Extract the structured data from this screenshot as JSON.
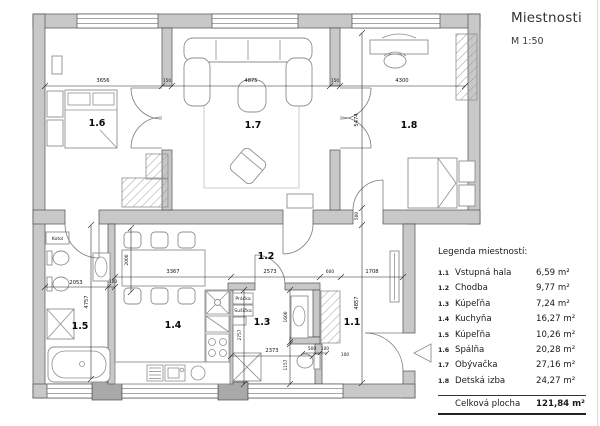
{
  "header": {
    "title": "Miestnosti",
    "scale": "M 1:50"
  },
  "legend": {
    "heading": "Legenda miestností:",
    "rows": [
      {
        "num": "1.1",
        "name": "Vstupná hala",
        "area": "6,59 m²"
      },
      {
        "num": "1.2",
        "name": "Chodba",
        "area": "9,77 m²"
      },
      {
        "num": "1.3",
        "name": "Kúpeľňa",
        "area": "7,24 m²"
      },
      {
        "num": "1.4",
        "name": "Kuchyňa",
        "area": "16,27 m²"
      },
      {
        "num": "1.5",
        "name": "Kúpeľňa",
        "area": "10,26 m²"
      },
      {
        "num": "1.6",
        "name": "Spálňa",
        "area": "20,28 m²"
      },
      {
        "num": "1.7",
        "name": "Obývačka",
        "area": "27,16 m²"
      },
      {
        "num": "1.8",
        "name": "Detská izba",
        "area": "24,27 m²"
      }
    ],
    "total_label": "Celková plocha",
    "total_area": "121,84 m²"
  },
  "plan": {
    "rooms": [
      "1.6",
      "1.7",
      "1.8",
      "1.2",
      "1.5",
      "1.4",
      "1.3",
      "1.1"
    ],
    "labels": {
      "boiler": "Kotol",
      "washer": "Práčka",
      "dryer": "Sušička"
    },
    "dims": [
      "3656",
      "150",
      "4875",
      "150",
      "4300",
      "5474",
      "500",
      "4857",
      "2053",
      "100",
      "4757",
      "2000",
      "3367",
      "2573",
      "600",
      "1708",
      "2373",
      "2757",
      "1600",
      "1157",
      "500",
      "100",
      "100"
    ],
    "colors": {
      "wall": "#c8c8c8",
      "pillar": "#a9a9a9",
      "line": "#4f4f4f"
    }
  }
}
